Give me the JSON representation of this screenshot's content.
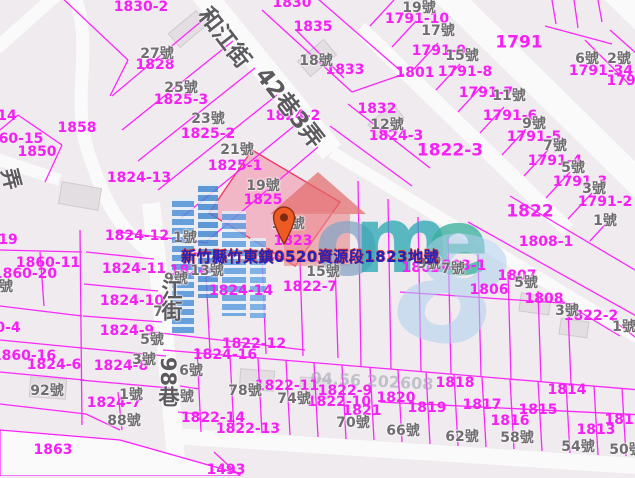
{
  "map": {
    "selected_parcel": {
      "address": "新竹縣竹東鎮0520資源段1823地號",
      "parcel_number": "1823",
      "highlight_fill": "#f2aabd"
    },
    "colors": {
      "parcel_line": "#fb1efb",
      "parcel_label": "#f520f5",
      "house_number_label": "#6f6d70",
      "road_fill": "#fbfafb",
      "block_fill": "#efebee",
      "address_label": "#2424bb",
      "address_label_shadow": "#d93025",
      "marker": "#ee5a24"
    },
    "streets": [
      {
        "t": "和江街",
        "x": 224,
        "y": 38,
        "r": 52,
        "s": 23
      },
      {
        "t": "42巷3弄",
        "x": 289,
        "y": 108,
        "r": 52,
        "s": 23
      },
      {
        "t": "江街",
        "x": 171,
        "y": 300,
        "v": 1,
        "s": 21
      },
      {
        "t": "98巷",
        "x": 168,
        "y": 382,
        "v": 1,
        "s": 21
      },
      {
        "t": "弄",
        "x": 11,
        "y": 179,
        "r": 75,
        "s": 21
      }
    ],
    "parcel_labels": [
      {
        "t": "1830-2",
        "x": 141,
        "y": 7
      },
      {
        "t": "1830",
        "x": 292,
        "y": 3
      },
      {
        "t": "1835",
        "x": 313,
        "y": 27
      },
      {
        "t": "1833",
        "x": 345,
        "y": 70
      },
      {
        "t": "1828",
        "x": 155,
        "y": 65
      },
      {
        "t": "1825-3",
        "x": 181,
        "y": 100
      },
      {
        "t": "1825-2",
        "x": 208,
        "y": 134
      },
      {
        "t": "1825-1",
        "x": 235,
        "y": 166
      },
      {
        "t": "1825",
        "x": 263,
        "y": 200
      },
      {
        "t": "1823",
        "x": 293,
        "y": 241
      },
      {
        "t": "1824-13",
        "x": 139,
        "y": 178
      },
      {
        "t": "1824-2",
        "x": 293,
        "y": 116
      },
      {
        "t": "1858",
        "x": 77,
        "y": 128
      },
      {
        "t": "1850",
        "x": 37,
        "y": 152
      },
      {
        "t": "60-15",
        "x": 21,
        "y": 139
      },
      {
        "t": "14",
        "x": 7,
        "y": 116
      },
      {
        "t": "19",
        "x": 8,
        "y": 240
      },
      {
        "t": "1791-10",
        "x": 417,
        "y": 19
      },
      {
        "t": "1791-9",
        "x": 439,
        "y": 51
      },
      {
        "t": "1791-8",
        "x": 465,
        "y": 72
      },
      {
        "t": "1791-7",
        "x": 486,
        "y": 93
      },
      {
        "t": "1791-6",
        "x": 510,
        "y": 116
      },
      {
        "t": "1791-5",
        "x": 534,
        "y": 137
      },
      {
        "t": "1791-4",
        "x": 555,
        "y": 161
      },
      {
        "t": "1791-3",
        "x": 580,
        "y": 182
      },
      {
        "t": "1791-2",
        "x": 605,
        "y": 202
      },
      {
        "t": "1791",
        "x": 519,
        "y": 43,
        "s": 17
      },
      {
        "t": "1791-34",
        "x": 601,
        "y": 71
      },
      {
        "t": "1791",
        "x": 626,
        "y": 81
      },
      {
        "t": "1801",
        "x": 415,
        "y": 73
      },
      {
        "t": "1832",
        "x": 377,
        "y": 109
      },
      {
        "t": "1824-3",
        "x": 396,
        "y": 136
      },
      {
        "t": "1822-3",
        "x": 450,
        "y": 151,
        "s": 17
      },
      {
        "t": "1822",
        "x": 530,
        "y": 212,
        "s": 17
      },
      {
        "t": "1808-1",
        "x": 546,
        "y": 242
      },
      {
        "t": "1803",
        "x": 421,
        "y": 268
      },
      {
        "t": "1803-1",
        "x": 459,
        "y": 266
      },
      {
        "t": "1807",
        "x": 517,
        "y": 276
      },
      {
        "t": "1806",
        "x": 489,
        "y": 290
      },
      {
        "t": "1808",
        "x": 544,
        "y": 299
      },
      {
        "t": "1822-2",
        "x": 591,
        "y": 316
      },
      {
        "t": "1822-7",
        "x": 310,
        "y": 287
      },
      {
        "t": "1824-14",
        "x": 241,
        "y": 291
      },
      {
        "t": "1824-1",
        "x": 197,
        "y": 271
      },
      {
        "t": "1824-12",
        "x": 137,
        "y": 236
      },
      {
        "t": "1824-11",
        "x": 134,
        "y": 269
      },
      {
        "t": "1824-10",
        "x": 132,
        "y": 301
      },
      {
        "t": "1824-9",
        "x": 127,
        "y": 331
      },
      {
        "t": "1860-11",
        "x": 48,
        "y": 263
      },
      {
        "t": "1860-20",
        "x": 25,
        "y": 274
      },
      {
        "t": "0-4",
        "x": 8,
        "y": 328
      },
      {
        "t": "1860-16",
        "x": 24,
        "y": 356
      },
      {
        "t": "1824-6",
        "x": 54,
        "y": 365
      },
      {
        "t": "1824-8",
        "x": 121,
        "y": 366
      },
      {
        "t": "1824-7",
        "x": 114,
        "y": 403
      },
      {
        "t": "1822-12",
        "x": 254,
        "y": 344
      },
      {
        "t": "1824-16",
        "x": 225,
        "y": 355
      },
      {
        "t": "1822-11",
        "x": 287,
        "y": 386
      },
      {
        "t": "1822-9",
        "x": 345,
        "y": 391
      },
      {
        "t": "1822-10",
        "x": 339,
        "y": 402
      },
      {
        "t": "1822-14",
        "x": 213,
        "y": 418
      },
      {
        "t": "1822-13",
        "x": 248,
        "y": 429
      },
      {
        "t": "1820",
        "x": 396,
        "y": 398
      },
      {
        "t": "1821",
        "x": 362,
        "y": 411
      },
      {
        "t": "1819",
        "x": 427,
        "y": 408
      },
      {
        "t": "1818",
        "x": 455,
        "y": 383
      },
      {
        "t": "1817",
        "x": 482,
        "y": 405
      },
      {
        "t": "1816",
        "x": 510,
        "y": 421
      },
      {
        "t": "1815",
        "x": 538,
        "y": 410
      },
      {
        "t": "1814",
        "x": 567,
        "y": 390
      },
      {
        "t": "1813",
        "x": 596,
        "y": 430
      },
      {
        "t": "1812",
        "x": 624,
        "y": 420
      },
      {
        "t": "1863",
        "x": 53,
        "y": 450
      },
      {
        "t": "1493",
        "x": 226,
        "y": 470
      }
    ],
    "house_numbers": [
      {
        "t": "27號",
        "x": 157,
        "y": 54
      },
      {
        "t": "25號",
        "x": 181,
        "y": 88
      },
      {
        "t": "23號",
        "x": 208,
        "y": 119
      },
      {
        "t": "21號",
        "x": 237,
        "y": 150
      },
      {
        "t": "19號",
        "x": 263,
        "y": 186
      },
      {
        "t": "17號",
        "x": 288,
        "y": 224
      },
      {
        "t": "15號",
        "x": 323,
        "y": 272
      },
      {
        "t": "13號",
        "x": 207,
        "y": 271
      },
      {
        "t": "18號",
        "x": 316,
        "y": 61
      },
      {
        "t": "12號",
        "x": 387,
        "y": 125
      },
      {
        "t": "19號",
        "x": 419,
        "y": 8
      },
      {
        "t": "17號",
        "x": 438,
        "y": 31
      },
      {
        "t": "15號",
        "x": 462,
        "y": 56
      },
      {
        "t": "11號",
        "x": 509,
        "y": 96
      },
      {
        "t": "9號",
        "x": 534,
        "y": 124
      },
      {
        "t": "7號",
        "x": 555,
        "y": 146
      },
      {
        "t": "5號",
        "x": 573,
        "y": 168
      },
      {
        "t": "3號",
        "x": 594,
        "y": 189
      },
      {
        "t": "1號",
        "x": 605,
        "y": 221
      },
      {
        "t": "6號",
        "x": 587,
        "y": 59
      },
      {
        "t": "2號",
        "x": 619,
        "y": 59
      },
      {
        "t": "1號",
        "x": 185,
        "y": 238
      },
      {
        "t": "9號",
        "x": 176,
        "y": 279
      },
      {
        "t": "7號",
        "x": 165,
        "y": 312
      },
      {
        "t": "5號",
        "x": 152,
        "y": 340
      },
      {
        "t": "3號",
        "x": 144,
        "y": 360
      },
      {
        "t": "1號",
        "x": 131,
        "y": 395
      },
      {
        "t": "88號",
        "x": 124,
        "y": 421
      },
      {
        "t": "92號",
        "x": 47,
        "y": 391
      },
      {
        "t": "6號",
        "x": 191,
        "y": 371
      },
      {
        "t": "2號",
        "x": 182,
        "y": 397
      },
      {
        "t": "78號",
        "x": 245,
        "y": 391
      },
      {
        "t": "74號",
        "x": 294,
        "y": 399
      },
      {
        "t": "70號",
        "x": 353,
        "y": 423
      },
      {
        "t": "66號",
        "x": 403,
        "y": 431
      },
      {
        "t": "62號",
        "x": 462,
        "y": 437
      },
      {
        "t": "58號",
        "x": 517,
        "y": 438
      },
      {
        "t": "54號",
        "x": 578,
        "y": 447
      },
      {
        "t": "50號",
        "x": 626,
        "y": 450
      },
      {
        "t": "9號",
        "x": 429,
        "y": 264
      },
      {
        "t": "7號",
        "x": 453,
        "y": 269
      },
      {
        "t": "5號",
        "x": 526,
        "y": 283
      },
      {
        "t": "3號",
        "x": 567,
        "y": 311
      },
      {
        "t": "1號",
        "x": 624,
        "y": 327
      },
      {
        "t": "號",
        "x": 6,
        "y": 287
      }
    ],
    "watermark": {
      "letters": [
        {
          "t": "o",
          "x": 347,
          "y": 243,
          "s": 95,
          "c": "#8ba6c6"
        },
        {
          "t": "m",
          "x": 402,
          "y": 241,
          "s": 92,
          "c": "#2fa9b5"
        },
        {
          "t": "e",
          "x": 458,
          "y": 243,
          "s": 92,
          "c": "#3bb09e"
        },
        {
          "t": "8",
          "x": 452,
          "y": 292,
          "s": 150,
          "c": "#aed0ee",
          "i": 1,
          "r": 14,
          "o": 0.55
        }
      ],
      "stamp": {
        "t": "04.56 202608",
        "x": 372,
        "y": 381
      }
    }
  }
}
